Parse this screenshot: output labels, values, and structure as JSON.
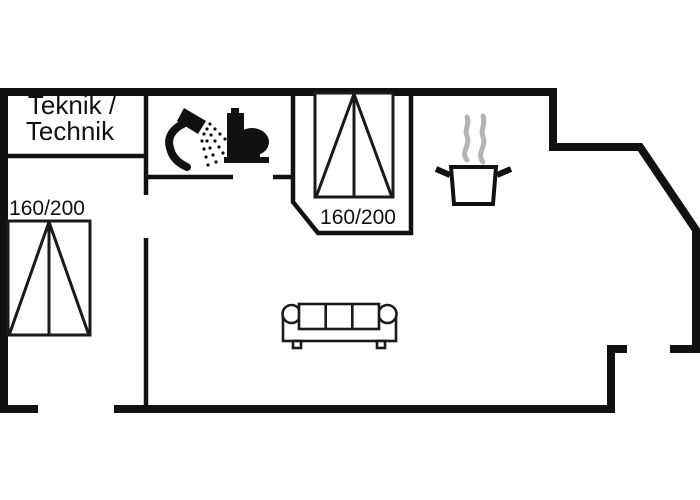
{
  "floorplan": {
    "type": "holiday-home floor plan",
    "colors": {
      "wall": "#111111",
      "background": "#ffffff",
      "steam": "#b4b4b4"
    },
    "rooms": {
      "utility_room": {
        "label_line1": "Teknik /",
        "label_line2": "Technik"
      },
      "bedroom_left": {
        "bed_size_label": "160/200"
      },
      "bedroom_middle": {
        "bed_size_label": "160/200"
      },
      "bathroom": {
        "icons": [
          "shower-icon",
          "toilet-icon"
        ]
      },
      "kitchen": {
        "icons": [
          "cooking-pot-icon"
        ]
      },
      "living_room": {
        "icons": [
          "sofa-icon"
        ]
      }
    }
  }
}
